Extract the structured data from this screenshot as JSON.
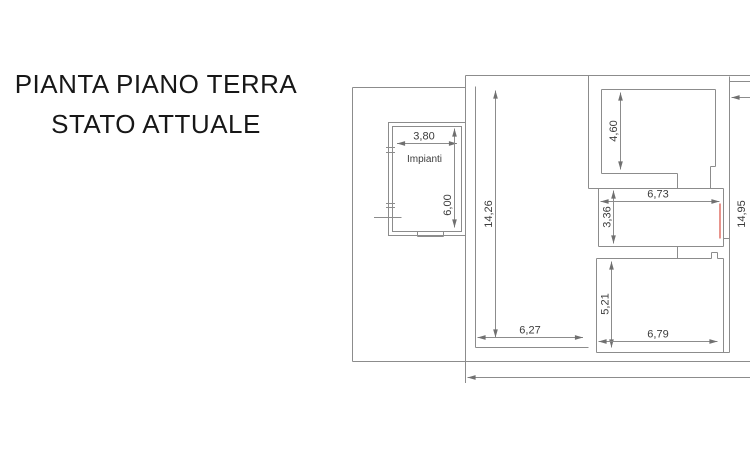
{
  "title": {
    "line1": "PIANTA PIANO TERRA",
    "line2": "STATO ATTUALE"
  },
  "plan": {
    "outbuilding": {
      "label": "Impianti",
      "width_dim": "3,80",
      "height_dim": "6,00"
    },
    "rooms": {
      "left_hall": {
        "height_dim": "14,26",
        "width_dim": "6,27"
      },
      "top_right": {
        "height_dim": "4,60"
      },
      "middle_right": {
        "width_dim": "6,73",
        "height_dim": "3,36"
      },
      "bottom_right": {
        "height_dim": "5,21",
        "width_dim": "6,79"
      },
      "right_wing": {
        "height_dim": "14,95"
      }
    },
    "colors": {
      "line": "#8c8c8c",
      "dim_text": "#3c3c3c",
      "highlight": "#e8948c",
      "title_text": "#171717"
    }
  }
}
